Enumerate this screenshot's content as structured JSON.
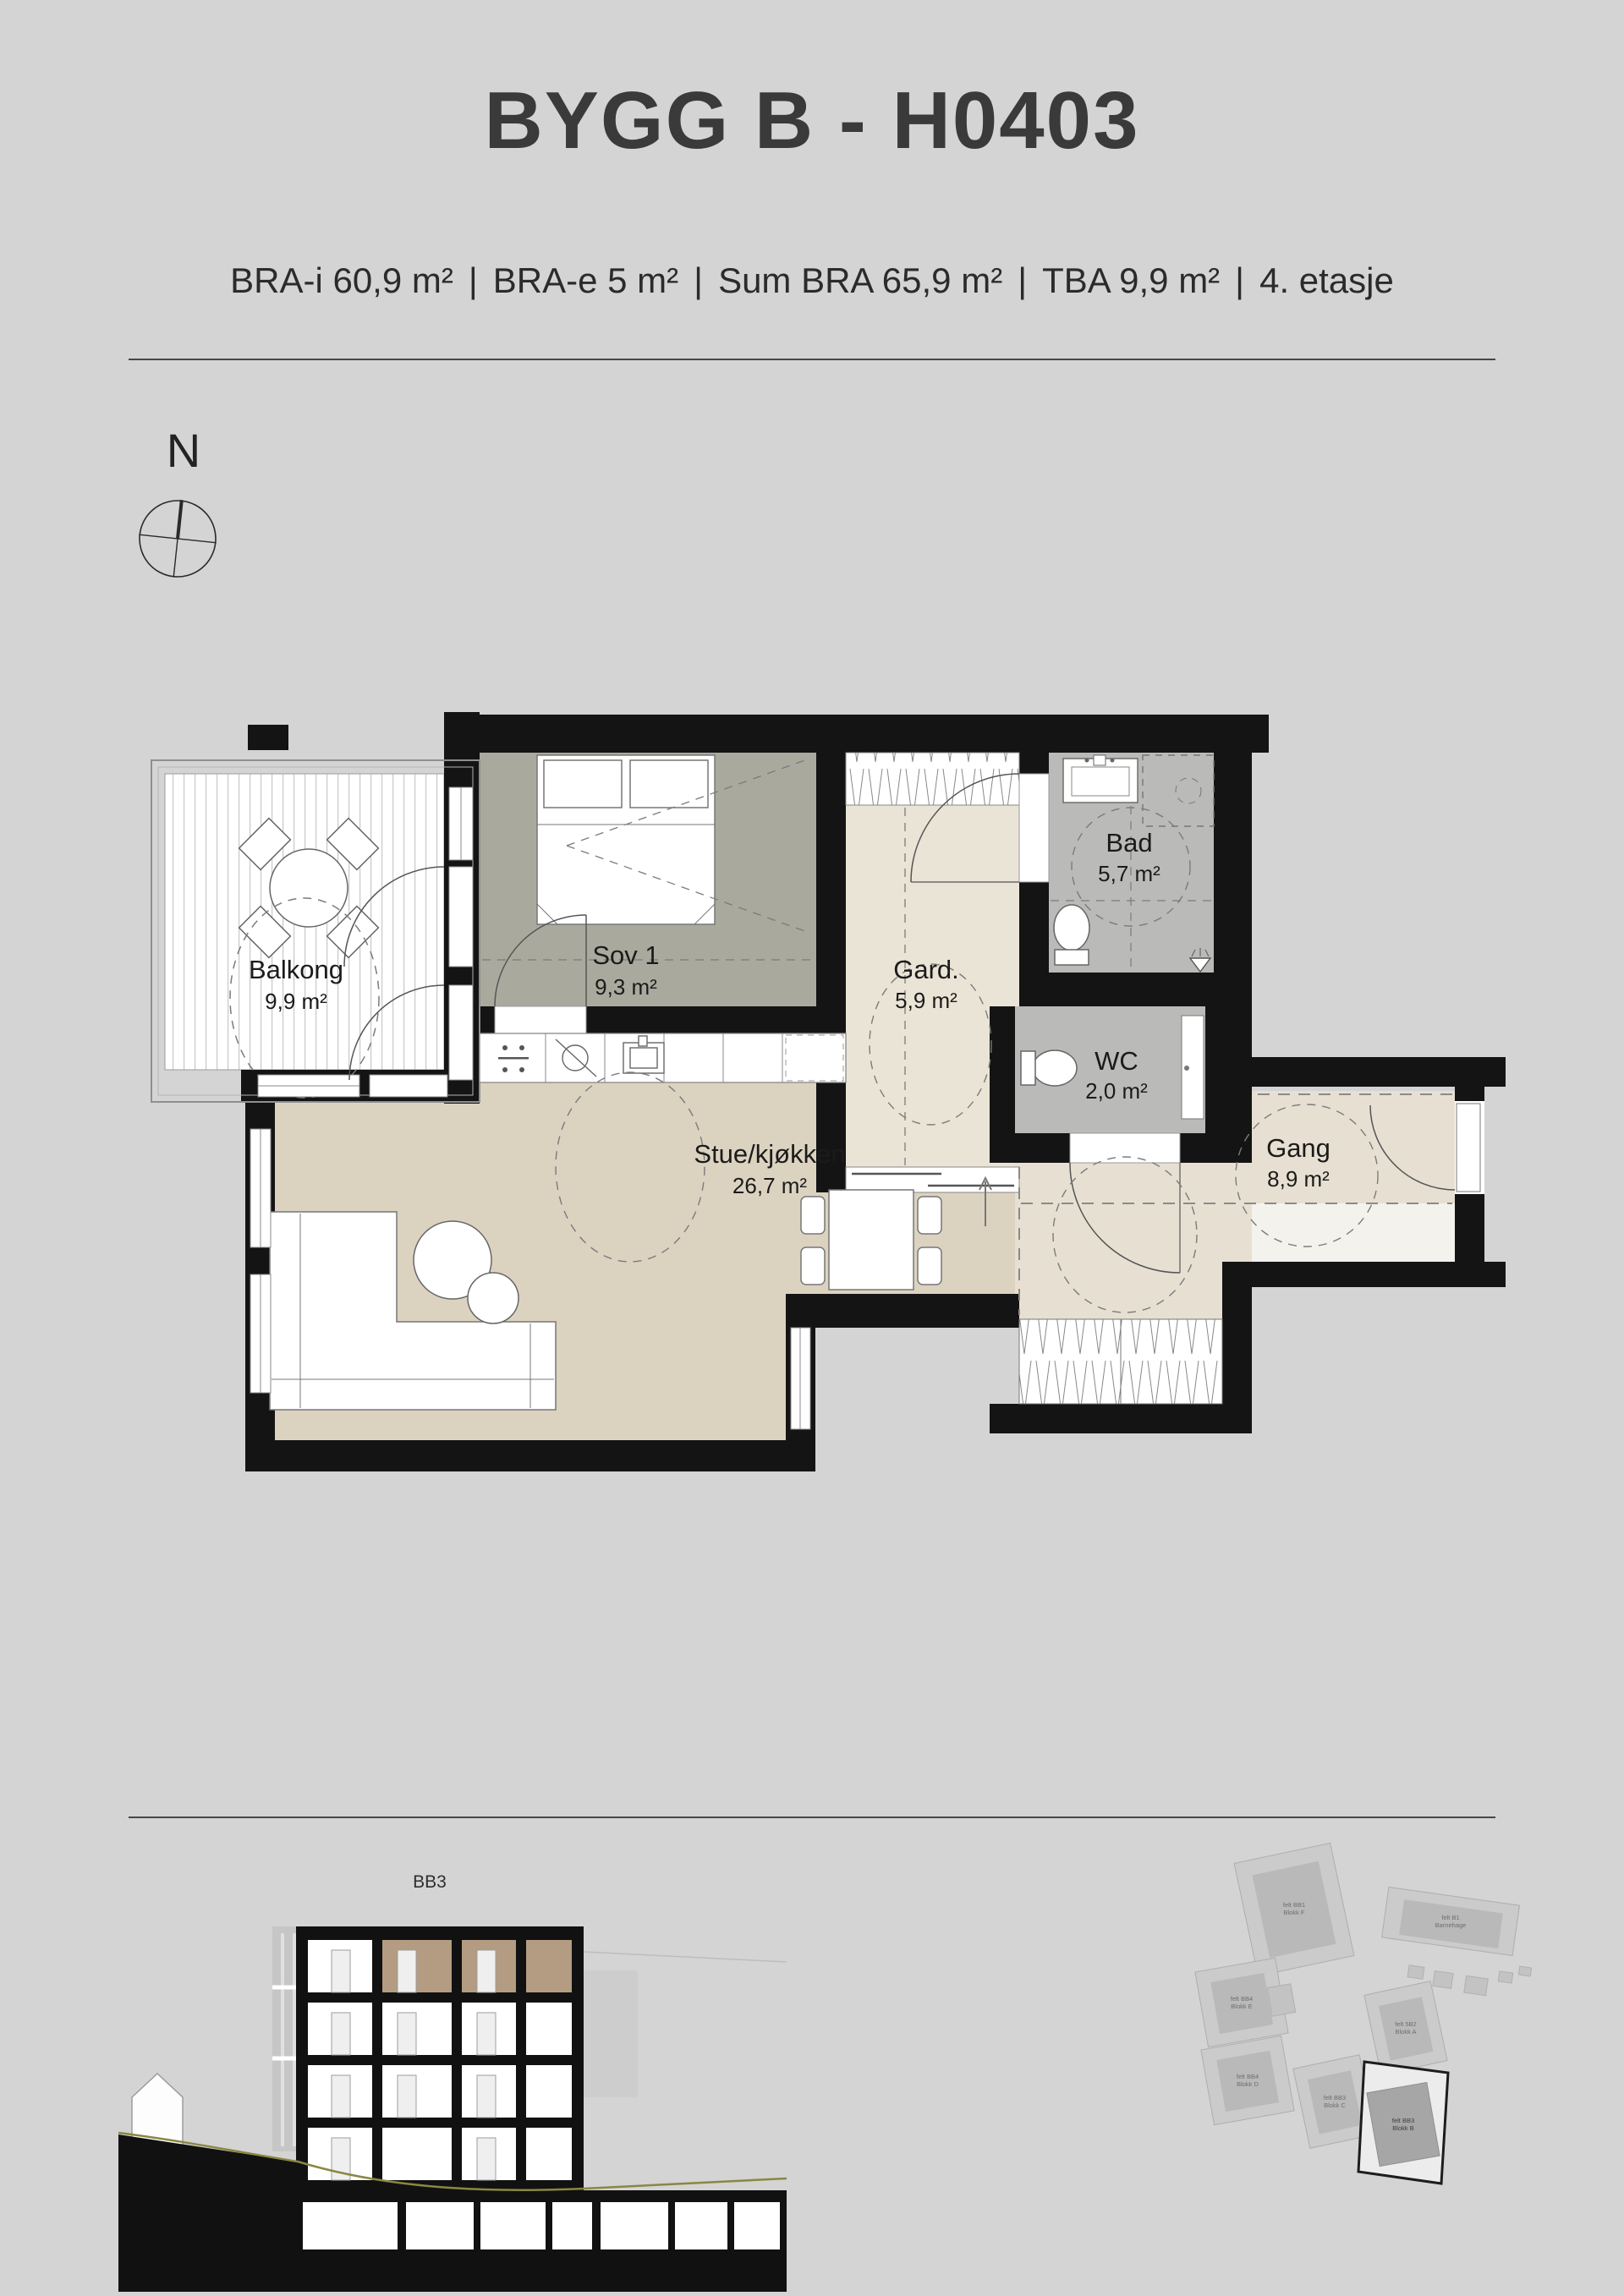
{
  "header": {
    "title": "BYGG B  - H0403",
    "separator": "|",
    "specs": [
      "BRA-i 60,9 m²",
      "BRA-e 5 m²",
      "Sum BRA 65,9 m²",
      "TBA 9,9 m²",
      "4. etasje"
    ]
  },
  "compass": {
    "north_label": "N"
  },
  "plan": {
    "rooms": [
      {
        "name": "Balkong",
        "area": "9,9 m²"
      },
      {
        "name": "Sov 1",
        "area": "9,3 m²"
      },
      {
        "name": "Gard.",
        "area": "5,9 m²"
      },
      {
        "name": "Bad",
        "area": "5,7 m²"
      },
      {
        "name": "WC",
        "area": "2,0 m²"
      },
      {
        "name": "Stue/kjøkken",
        "area": "26,7 m²"
      },
      {
        "name": "Gang",
        "area": "8,9 m²"
      }
    ]
  },
  "section": {
    "label": "BB3"
  },
  "siteplan": {
    "buildings": [
      {
        "label1": "felt BB1",
        "label2": "Blokk F"
      },
      {
        "label1": "felt B1",
        "label2": "Barnehage"
      },
      {
        "label1": "felt BB4",
        "label2": "Blokk E"
      },
      {
        "label1": "felt 5B2",
        "label2": "Blokk A"
      },
      {
        "label1": "felt BB4",
        "label2": "Blokk D"
      },
      {
        "label1": "felt BB3",
        "label2": "Blokk C"
      },
      {
        "label1": "felt BB3",
        "label2": "Blokk B"
      }
    ]
  }
}
